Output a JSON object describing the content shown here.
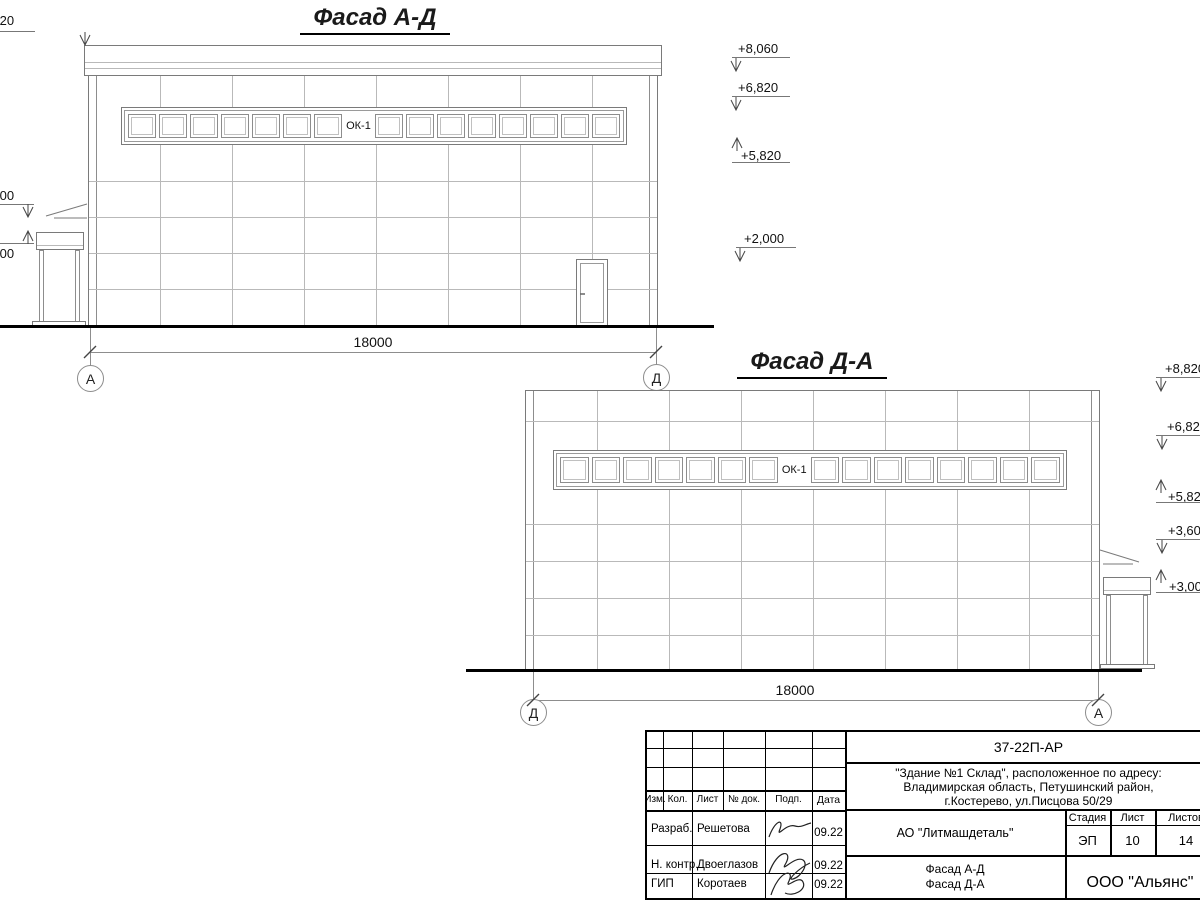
{
  "sheet": {
    "facade_ad": {
      "title": "Фасад А-Д",
      "window_label": "ОК-1",
      "dimension": "18000",
      "axis_left": "А",
      "axis_right": "Д",
      "marks_left": [
        "+8,820",
        "+3,600",
        "+3,000"
      ],
      "marks_right": [
        "+8,060",
        "+6,820",
        "+5,820",
        "+2,000"
      ]
    },
    "facade_da": {
      "title": "Фасад Д-А",
      "window_label": "ОК-1",
      "dimension": "18000",
      "axis_left": "Д",
      "axis_right": "А",
      "marks_right": [
        "+8,820",
        "+6,820",
        "+5,820",
        "+3,600",
        "+3,000"
      ]
    },
    "title_block": {
      "doc_number": "37-22П-АР",
      "object_line1": "\"Здание №1 Склад\", расположенное по адресу:",
      "object_line2": "Владимирская область, Петушинский район,",
      "object_line3": "г.Костерево, ул.Писцова 50/29",
      "client": "АО \"Литмашдеталь\"",
      "sheet_name_line1": "Фасад А-Д",
      "sheet_name_line2": "Фасад Д-А",
      "organization": "ООО \"Альянс\"",
      "stage_label": "Стадия",
      "stage_value": "ЭП",
      "sheet_label": "Лист",
      "sheet_value": "10",
      "total_label": "Листов",
      "total_value": "14",
      "header_cols": [
        "Изм.",
        "Кол.",
        "Лист",
        "№ док.",
        "Подп.",
        "Дата"
      ],
      "signature_rows": [
        {
          "role": "Разраб.",
          "name": "Решетова",
          "date": "09.22"
        },
        {
          "role": "Н. контр.",
          "name": "Двоеглазов",
          "date": "09.22"
        },
        {
          "role": "ГИП",
          "name": "Коротаев",
          "date": "09.22"
        }
      ]
    }
  }
}
